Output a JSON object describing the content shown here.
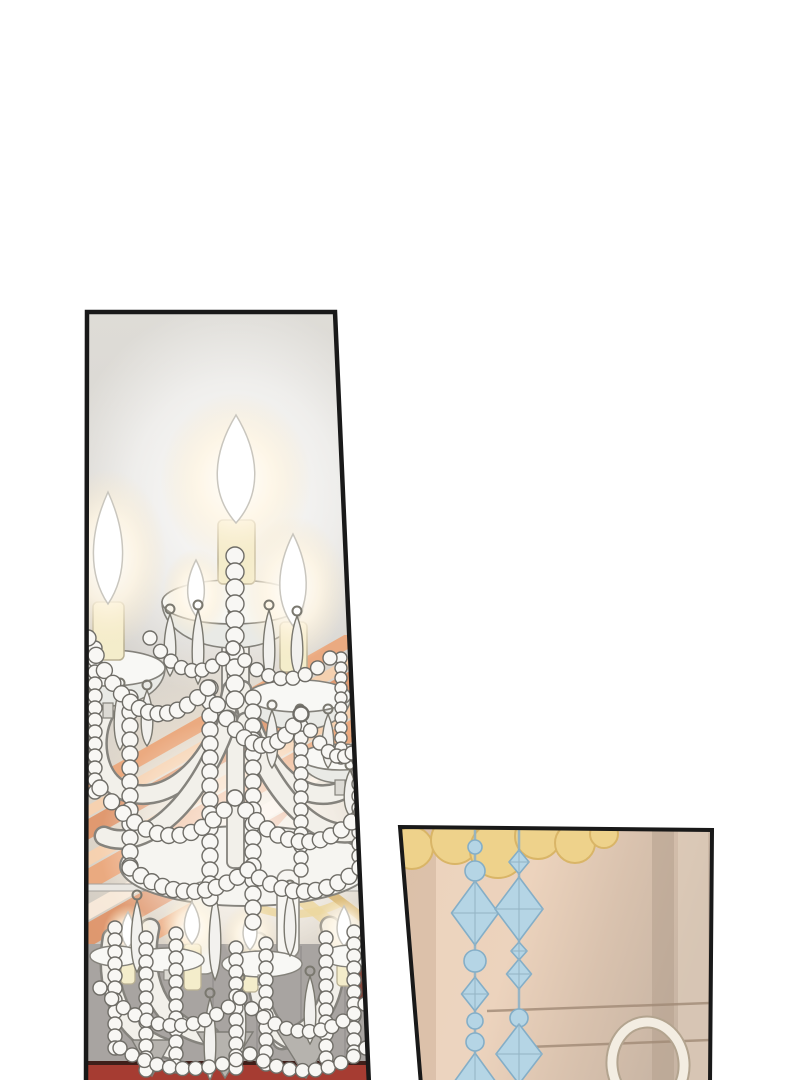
{
  "image": {
    "width": 800,
    "height": 1080,
    "kind": "manhwa-comic-page",
    "panels": 2
  },
  "palette": {
    "ink": "#191919",
    "page_bg": "#ffffff",
    "crystal_white": "#f8f7f4",
    "crystal_outline": "#6f6d67",
    "arm_fill": "#f2f0ea",
    "arm_outline": "#85837d",
    "candle_cream": "#f4edcb",
    "candle_outline": "#b9b093",
    "flame_white": "#ffffff",
    "flame_outline": "#c9c6be",
    "wall_gray": "#a8a4a1",
    "wall_line": "#96928f",
    "carpet_red": "#a63c32",
    "carpet_dark": "#3f1f1a",
    "maroon": "#7c382d",
    "stripe_orange": "#eca67a",
    "stripe_light": "#f7d0ae",
    "stripe_deep": "#e09468",
    "stripe_cream": "#faeada",
    "gold_swag": "#d9b672",
    "gold_swag_light": "#ecd7a0",
    "door_line": "#a18a76",
    "gold_blob": "#eed28b",
    "gold_outline": "#d9b567",
    "bead_blue": "#b5d5e5",
    "bead_blue_outline": "#84aec7",
    "bead_blue_facet": "#93b4c4",
    "chain_blue": "#8fb2c6",
    "ring_cream": "#f3ede2",
    "ring_outline": "#b3a48f"
  },
  "left_panel": {
    "title": "chandelier-panel",
    "polygon": "87,312 335,312 369,1085 86,1085",
    "stripes": {
      "pivot": [
        233,
        706
      ],
      "angle": -29.5,
      "clip": "87,622 366,636 366,728 208,903 152,1062 87,1062",
      "bands": [
        {
          "off": 0,
          "th": 14,
          "color": "#eca67a"
        },
        {
          "off": 20,
          "th": 10,
          "color": "#f7d0ae"
        },
        {
          "off": 36,
          "th": 18,
          "color": "#e09468"
        },
        {
          "off": 62,
          "th": 12,
          "color": "#f7d0ae"
        },
        {
          "off": 80,
          "th": 20,
          "color": "#eca67a"
        },
        {
          "off": 108,
          "th": 14,
          "color": "#faeada"
        },
        {
          "off": 128,
          "th": 22,
          "color": "#e09468"
        },
        {
          "off": 158,
          "th": 16,
          "color": "#eca67a"
        },
        {
          "off": 182,
          "th": 12,
          "color": "#f7d0ae"
        },
        {
          "off": 202,
          "th": 20,
          "color": "#eca67a"
        },
        {
          "off": 228,
          "th": 14,
          "color": "#e09468"
        }
      ]
    },
    "wall": {
      "x": 86,
      "y": 944,
      "w": 284,
      "h": 120
    },
    "wall_lines": [
      213,
      257,
      301,
      345
    ],
    "trim_line": {
      "x": 87,
      "y": 884,
      "w": 282,
      "h": 7
    },
    "maroon_patch": "352,948 368,942 368,1012 356,1006",
    "carpet": {
      "x": 85,
      "y": 1065,
      "w": 286,
      "h": 16
    },
    "carpet_edge": {
      "x": 85,
      "y": 1061,
      "w": 286,
      "h": 5
    },
    "gold_swags": [
      {
        "d": "M228,878 Q282,906 334,882",
        "color": "#d9b672",
        "w": 9
      },
      {
        "d": "M236,898 Q290,928 342,902",
        "color": "#ecd7a0",
        "w": 8
      },
      {
        "d": "M302,900 L366,952",
        "color": "#ecd7a0",
        "w": 12
      },
      {
        "d": "M318,884 L368,922",
        "color": "#d9b672",
        "w": 9
      }
    ],
    "canopy": {
      "cx": 246,
      "cy": 866,
      "rx": 126,
      "ry": 40
    },
    "column": [
      {
        "x": 222,
        "y": 552,
        "w": 27,
        "h": 152
      },
      {
        "x": 227,
        "y": 700,
        "w": 17,
        "h": 168
      }
    ],
    "arms": [
      "M232,690 C216,768 162,812 118,788 C96,774 92,738 104,714",
      "M242,690 C258,772 308,814 350,786",
      "M228,720 C196,812 140,852 104,836",
      "M246,722 C276,810 330,848 364,828",
      "M150,928 C138,988 168,1030 210,1036",
      "M330,926 C346,986 322,1032 282,1040",
      "M112,938 C102,998 130,1040 172,1050",
      "M258,942 C252,1000 268,1036 298,1042"
    ],
    "bobeches": [
      {
        "cx": 233,
        "cy": 602,
        "rx": 71,
        "ry": 22,
        "depth": 46
      },
      {
        "cx": 108,
        "cy": 668,
        "rx": 57,
        "ry": 18,
        "depth": 38
      },
      {
        "cx": 299,
        "cy": 696,
        "rx": 52,
        "ry": 16,
        "depth": 34
      },
      {
        "cx": 340,
        "cy": 757,
        "rx": 40,
        "ry": 13,
        "depth": 26
      }
    ],
    "candle_bodies": [
      {
        "x": 218,
        "y": 520,
        "w": 37,
        "h": 64
      },
      {
        "x": 93,
        "y": 602,
        "w": 31,
        "h": 58
      },
      {
        "x": 280,
        "y": 622,
        "w": 27,
        "h": 50
      }
    ],
    "tall_candles": [
      {
        "x": 192,
        "y": 882,
        "w": 24,
        "h": 92
      },
      {
        "x": 277,
        "y": 870,
        "w": 22,
        "h": 88
      }
    ],
    "lower_bodies": [
      {
        "x": 184,
        "y": 944,
        "w": 17,
        "h": 46
      },
      {
        "x": 243,
        "y": 950,
        "w": 15,
        "h": 42
      },
      {
        "x": 337,
        "y": 946,
        "w": 15,
        "h": 40
      },
      {
        "x": 121,
        "y": 948,
        "w": 14,
        "h": 36
      }
    ],
    "flames": [
      {
        "x": 236,
        "yTop": 415,
        "rx": 27,
        "h": 108
      },
      {
        "x": 108,
        "yTop": 492,
        "rx": 21,
        "h": 112
      },
      {
        "x": 293,
        "yTop": 534,
        "rx": 19,
        "h": 92
      },
      {
        "x": 196,
        "yTop": 560,
        "rx": 12,
        "h": 56
      },
      {
        "x": 192,
        "yTop": 902,
        "rx": 11,
        "h": 42
      },
      {
        "x": 250,
        "yTop": 912,
        "rx": 10,
        "h": 38
      },
      {
        "x": 344,
        "yTop": 906,
        "rx": 10,
        "h": 40
      },
      {
        "x": 128,
        "yTop": 912,
        "rx": 9,
        "h": 36
      }
    ],
    "lower_dishes": [
      {
        "cx": 168,
        "cy": 960,
        "rx": 36,
        "ry": 12
      },
      {
        "cx": 262,
        "cy": 964,
        "rx": 40,
        "ry": 13
      },
      {
        "cx": 352,
        "cy": 956,
        "rx": 30,
        "ry": 11
      },
      {
        "cx": 116,
        "cy": 956,
        "rx": 26,
        "ry": 10
      }
    ],
    "cones": [
      {
        "x": 225,
        "y": 1032,
        "w": 56,
        "h": 46
      },
      {
        "x": 306,
        "y": 1028,
        "w": 62,
        "h": 50
      },
      {
        "x": 152,
        "y": 1040,
        "w": 40,
        "h": 36
      }
    ],
    "teardrops": [
      {
        "x": 170,
        "y": 614,
        "len": 62
      },
      {
        "x": 198,
        "y": 610,
        "len": 74
      },
      {
        "x": 233,
        "y": 616,
        "len": 88
      },
      {
        "x": 269,
        "y": 610,
        "len": 72
      },
      {
        "x": 297,
        "y": 616,
        "len": 60
      },
      {
        "x": 92,
        "y": 682,
        "len": 50
      },
      {
        "x": 120,
        "y": 688,
        "len": 62
      },
      {
        "x": 147,
        "y": 690,
        "len": 56
      },
      {
        "x": 272,
        "y": 710,
        "len": 58
      },
      {
        "x": 300,
        "y": 714,
        "len": 68
      },
      {
        "x": 328,
        "y": 714,
        "len": 54
      },
      {
        "x": 350,
        "y": 770,
        "len": 46
      },
      {
        "x": 137,
        "y": 900,
        "len": 72
      },
      {
        "x": 215,
        "y": 894,
        "len": 86
      },
      {
        "x": 290,
        "y": 890,
        "len": 66
      },
      {
        "x": 240,
        "y": 982,
        "len": 76
      },
      {
        "x": 310,
        "y": 976,
        "len": 68
      },
      {
        "x": 210,
        "y": 998,
        "len": 82
      }
    ],
    "chains": [
      {
        "x": 235,
        "y1": 556,
        "y2": 700,
        "r": 9
      },
      {
        "x": 210,
        "y1": 688,
        "y2": 902,
        "r": 8
      },
      {
        "x": 253,
        "y1": 698,
        "y2": 928,
        "r": 8
      },
      {
        "x": 301,
        "y1": 714,
        "y2": 878,
        "r": 7
      },
      {
        "x": 130,
        "y1": 698,
        "y2": 878,
        "r": 8
      },
      {
        "x": 95,
        "y1": 648,
        "y2": 798,
        "r": 7
      },
      {
        "x": 359,
        "y1": 700,
        "y2": 858,
        "r": 7
      },
      {
        "x": 341,
        "y1": 658,
        "y2": 758,
        "r": 6
      },
      {
        "x": 115,
        "y1": 928,
        "y2": 1058,
        "r": 7
      },
      {
        "x": 146,
        "y1": 938,
        "y2": 1074,
        "r": 7
      },
      {
        "x": 176,
        "y1": 934,
        "y2": 1068,
        "r": 7
      },
      {
        "x": 236,
        "y1": 948,
        "y2": 1078,
        "r": 7
      },
      {
        "x": 266,
        "y1": 944,
        "y2": 1072,
        "r": 7
      },
      {
        "x": 326,
        "y1": 938,
        "y2": 1068,
        "r": 7
      },
      {
        "x": 354,
        "y1": 932,
        "y2": 1062,
        "r": 7
      }
    ],
    "garlands": [
      {
        "x1": 88,
        "y1": 638,
        "cx": 140,
        "cy": 758,
        "x2": 208,
        "y2": 688,
        "n": 14,
        "r": 8
      },
      {
        "x1": 208,
        "y1": 688,
        "cx": 260,
        "cy": 788,
        "x2": 301,
        "y2": 714,
        "n": 12,
        "r": 8
      },
      {
        "x1": 301,
        "y1": 714,
        "cx": 340,
        "cy": 788,
        "x2": 366,
        "y2": 734,
        "n": 9,
        "r": 7
      },
      {
        "x1": 100,
        "y1": 788,
        "cx": 170,
        "cy": 878,
        "x2": 235,
        "y2": 798,
        "n": 13,
        "r": 8
      },
      {
        "x1": 235,
        "y1": 798,
        "cx": 300,
        "cy": 878,
        "x2": 362,
        "y2": 812,
        "n": 13,
        "r": 8
      },
      {
        "x1": 150,
        "y1": 638,
        "cx": 192,
        "cy": 698,
        "x2": 233,
        "y2": 648,
        "n": 9,
        "r": 7
      },
      {
        "x1": 233,
        "y1": 648,
        "cx": 280,
        "cy": 704,
        "x2": 330,
        "y2": 658,
        "n": 9,
        "r": 7
      },
      {
        "x1": 130,
        "y1": 868,
        "cx": 190,
        "cy": 914,
        "x2": 248,
        "y2": 870,
        "n": 12,
        "r": 8
      },
      {
        "x1": 248,
        "y1": 870,
        "cx": 305,
        "cy": 914,
        "x2": 360,
        "y2": 868,
        "n": 11,
        "r": 8
      },
      {
        "x1": 100,
        "y1": 988,
        "cx": 170,
        "cy": 1058,
        "x2": 240,
        "y2": 998,
        "n": 13,
        "r": 7
      },
      {
        "x1": 240,
        "y1": 998,
        "cx": 305,
        "cy": 1062,
        "x2": 365,
        "y2": 1004,
        "n": 12,
        "r": 7
      },
      {
        "x1": 120,
        "y1": 1048,
        "cx": 180,
        "cy": 1086,
        "x2": 250,
        "y2": 1054,
        "n": 11,
        "r": 7
      },
      {
        "x1": 250,
        "y1": 1054,
        "cx": 310,
        "cy": 1090,
        "x2": 366,
        "y2": 1048,
        "n": 10,
        "r": 7
      }
    ]
  },
  "right_panel": {
    "title": "door-panel",
    "polygon": "400,827 712,830 710,1085 421,1085",
    "shade_bands": [
      {
        "x": 652,
        "w": 22,
        "color": "#b5a18e",
        "op": 0.55
      },
      {
        "x": 678,
        "w": 30,
        "color": "#e6d5c4",
        "op": 0.5
      },
      {
        "x": 402,
        "w": 34,
        "color": "#c9ad97",
        "op": 0.45
      },
      {
        "x": 436,
        "w": 40,
        "color": "#eed8c2",
        "op": 0.4
      }
    ],
    "gold_blobs": [
      {
        "cx": 412,
        "cy": 848,
        "r": 21
      },
      {
        "cx": 455,
        "cy": 840,
        "r": 24
      },
      {
        "cx": 498,
        "cy": 850,
        "r": 28
      },
      {
        "cx": 538,
        "cy": 836,
        "r": 23
      },
      {
        "cx": 575,
        "cy": 843,
        "r": 20
      },
      {
        "cx": 604,
        "cy": 834,
        "r": 14
      }
    ],
    "door_lines": [
      {
        "x1": 487,
        "y1": 1011,
        "x2": 710,
        "y2": 1003
      },
      {
        "x1": 502,
        "y1": 1048,
        "x2": 710,
        "y2": 1040
      }
    ],
    "strands": [
      {
        "x": 475,
        "beads": [
          {
            "t": "c",
            "y": 847,
            "r": 7
          },
          {
            "t": "c",
            "y": 871,
            "r": 10
          },
          {
            "t": "d",
            "y": 913,
            "w": 47,
            "h": 64
          },
          {
            "t": "c",
            "y": 961,
            "r": 11
          },
          {
            "t": "d",
            "y": 994,
            "w": 27,
            "h": 34
          },
          {
            "t": "c",
            "y": 1021,
            "r": 8
          },
          {
            "t": "c",
            "y": 1042,
            "r": 9
          },
          {
            "t": "d",
            "y": 1082,
            "w": 42,
            "h": 58
          }
        ]
      },
      {
        "x": 519,
        "beads": [
          {
            "t": "d",
            "y": 862,
            "w": 20,
            "h": 24
          },
          {
            "t": "d",
            "y": 909,
            "w": 48,
            "h": 64
          },
          {
            "t": "d",
            "y": 951,
            "w": 16,
            "h": 18
          },
          {
            "t": "d",
            "y": 974,
            "w": 25,
            "h": 30
          },
          {
            "t": "c",
            "y": 1018,
            "r": 9
          },
          {
            "t": "d",
            "y": 1054,
            "w": 46,
            "h": 60
          }
        ]
      }
    ],
    "ring": {
      "cx": 648,
      "cy": 1064,
      "rx": 36,
      "ry": 42,
      "rot": -6
    }
  }
}
